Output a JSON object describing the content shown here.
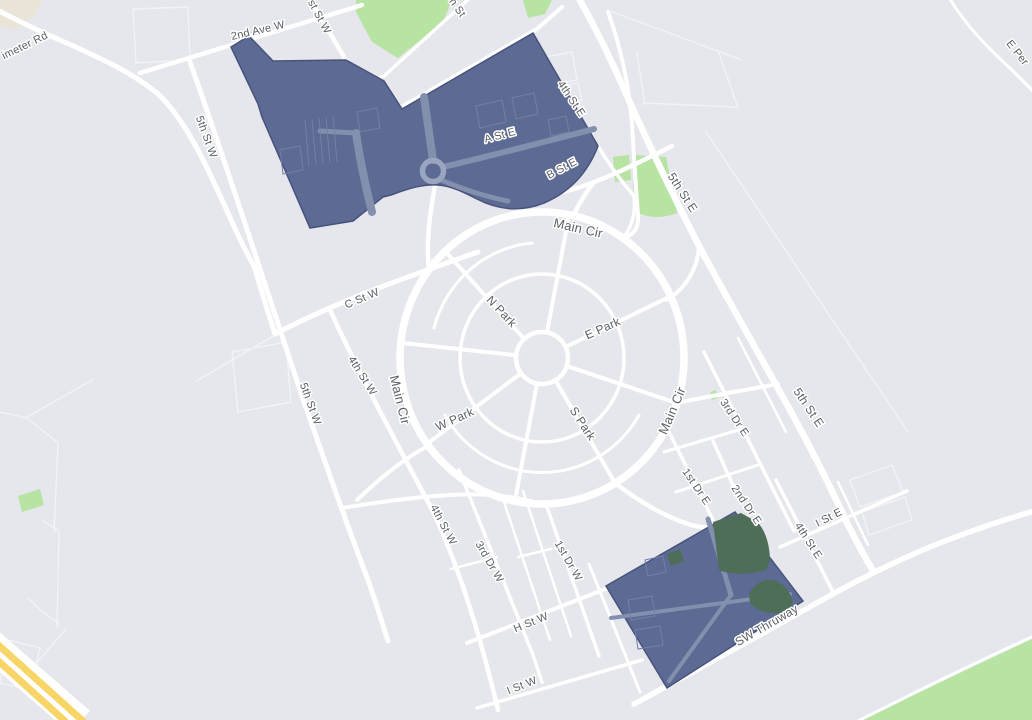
{
  "map": {
    "type": "street-map",
    "colors": {
      "background": "#e5e7ec",
      "road": "#ffffff",
      "road_faint": "#f2f3f6",
      "park_green": "#b7e3a3",
      "park_dark_green": "#4e6e58",
      "beige_area": "#eae4d8",
      "highway_yellow": "#f7d567",
      "overlay_fill": "#5d6b94",
      "overlay_border": "#47537d",
      "overlay_road": "#8290ae",
      "label_text": "#5b5f66",
      "label_halo": "#ffffff"
    },
    "labels": [
      {
        "text": "imeter Rd",
        "x": 25,
        "y": 46,
        "rotate": -26,
        "size": 11
      },
      {
        "text": "2nd Ave W",
        "x": 258,
        "y": 31,
        "rotate": -13,
        "size": 11
      },
      {
        "text": "st St W",
        "x": 319,
        "y": 17,
        "rotate": 62,
        "size": 11
      },
      {
        "text": "h St",
        "x": 457,
        "y": 8,
        "rotate": 55,
        "size": 11
      },
      {
        "text": "4th St E",
        "x": 571,
        "y": 99,
        "rotate": 56,
        "size": 11
      },
      {
        "text": "A St E",
        "x": 500,
        "y": 136,
        "rotate": -15,
        "size": 11
      },
      {
        "text": "B St E",
        "x": 562,
        "y": 169,
        "rotate": -28,
        "size": 11
      },
      {
        "text": "5th St E",
        "x": 682,
        "y": 193,
        "rotate": 57,
        "size": 12
      },
      {
        "text": "Main Cir",
        "x": 578,
        "y": 229,
        "rotate": 13,
        "size": 13
      },
      {
        "text": "C St W",
        "x": 362,
        "y": 299,
        "rotate": -23,
        "size": 11
      },
      {
        "text": "N Park",
        "x": 501,
        "y": 312,
        "rotate": 47,
        "size": 12
      },
      {
        "text": "E Park",
        "x": 603,
        "y": 329,
        "rotate": -24,
        "size": 12
      },
      {
        "text": "5th St W",
        "x": 206,
        "y": 137,
        "rotate": 70,
        "size": 11
      },
      {
        "text": "4th St W",
        "x": 362,
        "y": 376,
        "rotate": 58,
        "size": 11
      },
      {
        "text": "Main Cir",
        "x": 399,
        "y": 400,
        "rotate": 76,
        "size": 13
      },
      {
        "text": "5th St W",
        "x": 310,
        "y": 404,
        "rotate": 70,
        "size": 11
      },
      {
        "text": "W Park",
        "x": 455,
        "y": 420,
        "rotate": -24,
        "size": 12
      },
      {
        "text": "S Park",
        "x": 582,
        "y": 424,
        "rotate": 57,
        "size": 12
      },
      {
        "text": "Main Cir",
        "x": 673,
        "y": 411,
        "rotate": -67,
        "size": 13
      },
      {
        "text": "5th St E",
        "x": 808,
        "y": 408,
        "rotate": 56,
        "size": 12
      },
      {
        "text": "3rd Dr E",
        "x": 734,
        "y": 418,
        "rotate": 56,
        "size": 11
      },
      {
        "text": "1st Dr E",
        "x": 696,
        "y": 487,
        "rotate": 56,
        "size": 11
      },
      {
        "text": "2nd Dr E",
        "x": 746,
        "y": 505,
        "rotate": 56,
        "size": 11
      },
      {
        "text": "I St E",
        "x": 829,
        "y": 518,
        "rotate": -27,
        "size": 11
      },
      {
        "text": "4th St E",
        "x": 808,
        "y": 541,
        "rotate": 57,
        "size": 11
      },
      {
        "text": "4th St W",
        "x": 443,
        "y": 525,
        "rotate": 62,
        "size": 11
      },
      {
        "text": "3rd Dr W",
        "x": 489,
        "y": 562,
        "rotate": 60,
        "size": 11
      },
      {
        "text": "1st Dr W",
        "x": 568,
        "y": 561,
        "rotate": 60,
        "size": 11
      },
      {
        "text": "H St W",
        "x": 531,
        "y": 623,
        "rotate": -22,
        "size": 11
      },
      {
        "text": "I St W",
        "x": 522,
        "y": 686,
        "rotate": -22,
        "size": 11
      },
      {
        "text": "SW Thruway",
        "x": 767,
        "y": 626,
        "rotate": -30,
        "size": 12
      },
      {
        "text": "E Per",
        "x": 1017,
        "y": 53,
        "rotate": 52,
        "size": 11
      }
    ]
  }
}
